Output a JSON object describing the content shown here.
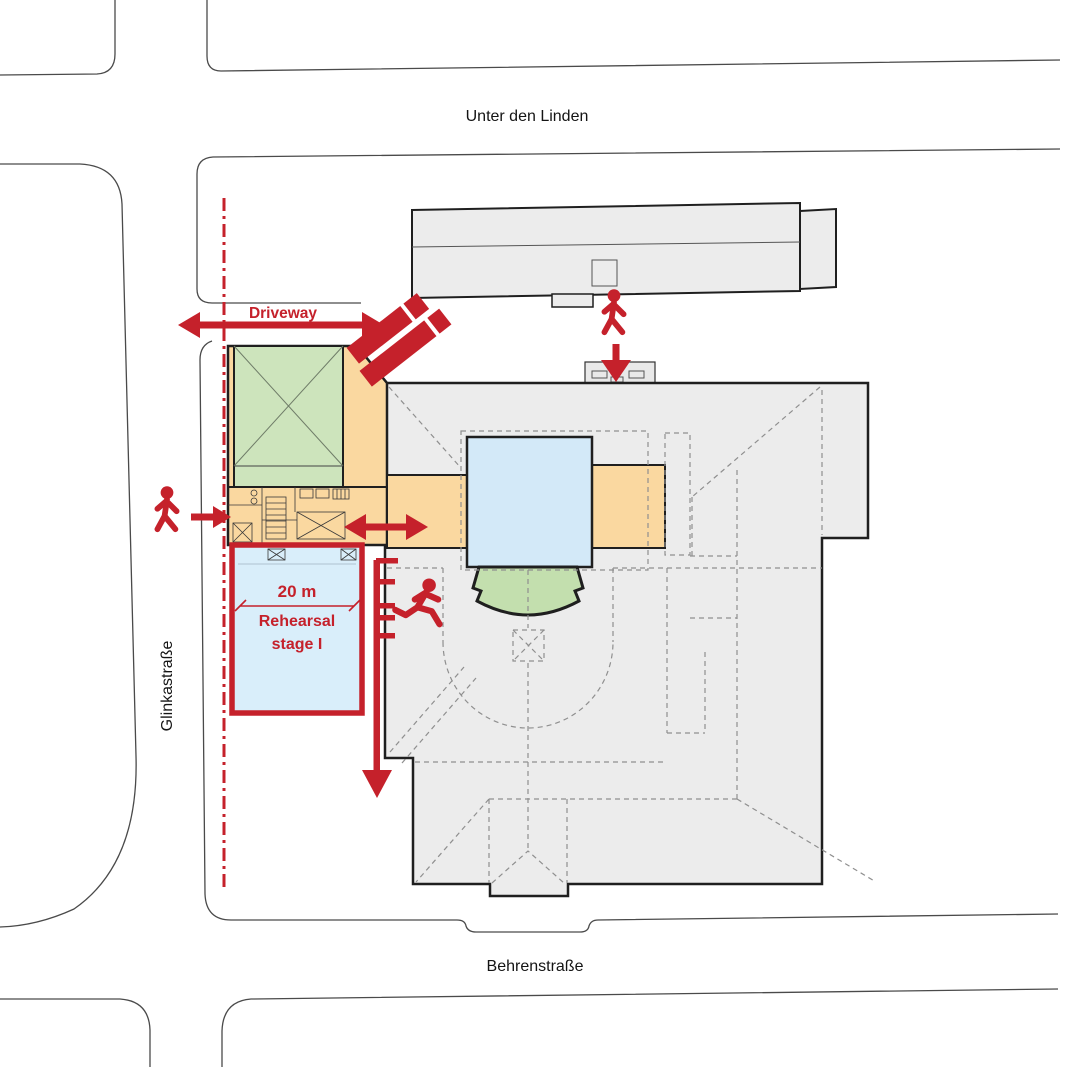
{
  "diagram": {
    "type": "architectural-site-plan",
    "streets": {
      "north": "Unter den Linden",
      "west": "Glinkastraße",
      "south": "Behrenstraße"
    },
    "annotations": {
      "driveway_label": "Driveway",
      "dimension_label": "20 m",
      "rehearsal_line1": "Rehearsal",
      "rehearsal_line2": "stage I"
    },
    "icons": {
      "pedestrian_icon": "walking person pictogram",
      "running_person_icon": "running person pictogram",
      "truck_icon": "delivery trucks pictogram",
      "arrow_icon": "red access/escape arrows"
    },
    "colors": {
      "annotation_red": "#c5212b",
      "stage_blue": "#d3e9f8",
      "rehearsal_blue": "#d9eefa",
      "side_stage_orange": "#fad8a0",
      "hall_green": "#cde4bc",
      "fan_green": "#c3dfae",
      "building_gray": "#ececec",
      "outline_black": "#1f1f1f",
      "street_line": "#4a4a4a",
      "dashed_line": "#8f8f8f"
    }
  }
}
